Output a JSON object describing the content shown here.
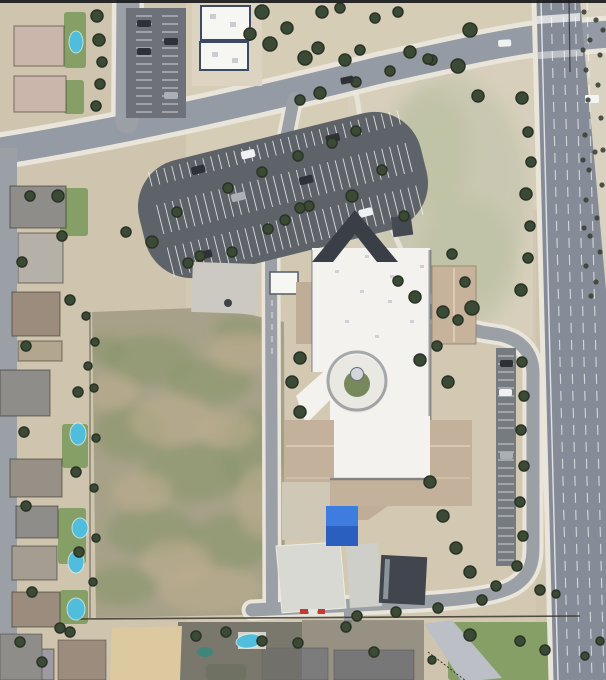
{
  "meta": {
    "view": "satellite-aerial-imagery",
    "width": 606,
    "height": 680
  },
  "visible_text": [],
  "palette": {
    "dirt": "#cfc5ae",
    "dirtLight": "#dcd4c0",
    "campusDirt": "#d3c9b3",
    "neLotDirt": "#d7cfbb",
    "nePatch": "#c8c7b0",
    "nePatchGreen": "#b9bfa1",
    "scrubDirt": "#d9d2c0",
    "fieldBase": "#a6a188",
    "fieldGreen": "#86966a",
    "fieldBrown": "#bcae8e",
    "lawn": "#7c9a5e",
    "road": "#959ba4",
    "roadMinor": "#9aa0a6",
    "roadMajor": "#858c97",
    "asphaltLot": "#5e636a",
    "asphaltAisle": "#767b82",
    "northLot": "#6d727a",
    "sidewalk": "#e9e5da",
    "white": "#f6f6f3",
    "whiteRoof": "#f3f2ee",
    "roofSpeck": "#c6cacf",
    "navyShadow": "#3d4a66",
    "shadow": "#4e555e",
    "roofTanEast": "#c7b29b",
    "roofTanBand": "#c4b19b",
    "roofTanSmall": "#c0ad97",
    "roofDark": "#3a3f47",
    "darkBuilding": "#41464e",
    "concrete": "#d9d9d3",
    "concreteTan": "#cfc8b6",
    "padGray": "#cbc9c2",
    "blueCanopy": "#3f7ce0",
    "blueCanopyDark": "#2a5fc0",
    "pool": "#4fbddb",
    "poolDark": "#3f8579",
    "tree": "#3b4a34",
    "treeDark": "#2a3326",
    "scrub": "#3c4136",
    "stripeWhite": "#f2f2ee",
    "red": "#c33b2f",
    "fence": "#3b382f",
    "domeGray": "#d3d6da",
    "rotundaGreen": "#76885c",
    "carDark": "#2e3238",
    "carWhite": "#f0f1f2",
    "carSilver": "#aab0b6",
    "houseRoofs": {
      "pink": "#cbb6ac",
      "gray": "#8f8d8a",
      "gray2": "#9b9ba1",
      "lightgray": "#b5b0a8",
      "brown": "#9b8c7e",
      "brown2": "#979086",
      "tan": "#b3a68f",
      "tan2": "#a59d92",
      "slate": "#8f9197",
      "pale": "#bcbfc6"
    }
  },
  "scene": {
    "trees": [
      [
        97,
        16,
        6
      ],
      [
        99,
        40,
        6
      ],
      [
        102,
        62,
        5
      ],
      [
        100,
        84,
        5
      ],
      [
        96,
        106,
        5
      ],
      [
        58,
        196,
        6
      ],
      [
        30,
        196,
        5
      ],
      [
        262,
        12,
        7
      ],
      [
        250,
        34,
        6
      ],
      [
        270,
        44,
        7
      ],
      [
        287,
        28,
        6
      ],
      [
        305,
        58,
        7
      ],
      [
        322,
        12,
        6
      ],
      [
        340,
        8,
        5
      ],
      [
        318,
        48,
        6
      ],
      [
        345,
        60,
        6
      ],
      [
        360,
        50,
        5
      ],
      [
        375,
        18,
        5
      ],
      [
        398,
        12,
        5
      ],
      [
        410,
        52,
        6
      ],
      [
        432,
        60,
        5
      ],
      [
        470,
        30,
        7
      ],
      [
        458,
        66,
        7
      ],
      [
        478,
        96,
        6
      ],
      [
        522,
        98,
        6
      ],
      [
        528,
        132,
        5
      ],
      [
        531,
        162,
        5
      ],
      [
        526,
        194,
        6
      ],
      [
        530,
        226,
        5
      ],
      [
        528,
        258,
        5
      ],
      [
        521,
        290,
        6
      ],
      [
        472,
        308,
        7
      ],
      [
        443,
        312,
        6
      ],
      [
        415,
        297,
        6
      ],
      [
        398,
        281,
        5
      ],
      [
        152,
        242,
        6
      ],
      [
        177,
        212,
        5
      ],
      [
        200,
        256,
        5
      ],
      [
        228,
        188,
        5
      ],
      [
        262,
        172,
        5
      ],
      [
        298,
        156,
        5
      ],
      [
        332,
        143,
        5
      ],
      [
        309,
        206,
        5
      ],
      [
        268,
        229,
        5
      ],
      [
        232,
        252,
        5
      ],
      [
        188,
        263,
        5
      ],
      [
        356,
        131,
        5
      ],
      [
        352,
        196,
        6
      ],
      [
        382,
        170,
        5
      ],
      [
        126,
        232,
        5
      ],
      [
        320,
        93,
        6
      ],
      [
        300,
        100,
        5
      ],
      [
        356,
        82,
        5
      ],
      [
        390,
        71,
        5
      ],
      [
        428,
        59,
        5
      ],
      [
        300,
        358,
        6
      ],
      [
        292,
        382,
        6
      ],
      [
        300,
        412,
        6
      ],
      [
        420,
        360,
        6
      ],
      [
        437,
        346,
        5
      ],
      [
        448,
        382,
        6
      ],
      [
        458,
        320,
        5
      ],
      [
        404,
        216,
        5
      ],
      [
        300,
        208,
        5
      ],
      [
        285,
        220,
        5
      ],
      [
        430,
        482,
        6
      ],
      [
        443,
        516,
        6
      ],
      [
        456,
        548,
        6
      ],
      [
        470,
        572,
        6
      ],
      [
        496,
        586,
        5
      ],
      [
        452,
        254,
        5
      ],
      [
        465,
        282,
        5
      ],
      [
        522,
        362,
        5
      ],
      [
        524,
        396,
        5
      ],
      [
        521,
        430,
        5
      ],
      [
        524,
        466,
        5
      ],
      [
        520,
        502,
        5
      ],
      [
        523,
        536,
        5
      ],
      [
        517,
        566,
        5
      ],
      [
        540,
        590,
        5
      ],
      [
        556,
        594,
        4
      ],
      [
        357,
        616,
        5
      ],
      [
        396,
        612,
        5
      ],
      [
        438,
        608,
        5
      ],
      [
        482,
        600,
        5
      ],
      [
        95,
        342,
        4
      ],
      [
        94,
        388,
        4
      ],
      [
        96,
        438,
        4
      ],
      [
        94,
        488,
        4
      ],
      [
        96,
        538,
        4
      ],
      [
        93,
        582,
        4
      ],
      [
        62,
        236,
        5
      ],
      [
        22,
        262,
        5
      ],
      [
        70,
        300,
        5
      ],
      [
        26,
        346,
        5
      ],
      [
        78,
        392,
        5
      ],
      [
        24,
        432,
        5
      ],
      [
        76,
        472,
        5
      ],
      [
        26,
        506,
        5
      ],
      [
        79,
        552,
        5
      ],
      [
        32,
        592,
        5
      ],
      [
        70,
        632,
        5
      ],
      [
        42,
        662,
        5
      ],
      [
        86,
        316,
        4
      ],
      [
        88,
        366,
        4
      ],
      [
        196,
        636,
        5
      ],
      [
        226,
        632,
        5
      ],
      [
        262,
        641,
        5
      ],
      [
        298,
        643,
        5
      ],
      [
        346,
        627,
        5
      ],
      [
        374,
        652,
        5
      ],
      [
        470,
        635,
        6
      ],
      [
        520,
        641,
        5
      ],
      [
        545,
        650,
        5
      ],
      [
        585,
        656,
        4
      ],
      [
        600,
        641,
        4
      ],
      [
        432,
        660,
        4
      ],
      [
        60,
        628,
        5
      ],
      [
        20,
        642,
        5
      ]
    ],
    "scrub": [
      [
        584,
        12
      ],
      [
        596,
        20
      ],
      [
        590,
        40
      ],
      [
        600,
        55
      ],
      [
        586,
        70
      ],
      [
        598,
        85
      ],
      [
        588,
        100
      ],
      [
        601,
        118
      ],
      [
        585,
        135
      ],
      [
        595,
        152
      ],
      [
        589,
        170
      ],
      [
        602,
        185
      ],
      [
        586,
        200
      ],
      [
        597,
        218
      ],
      [
        590,
        236
      ],
      [
        600,
        252
      ],
      [
        586,
        266
      ],
      [
        596,
        282
      ],
      [
        591,
        296
      ],
      [
        603,
        30
      ],
      [
        603,
        150
      ],
      [
        583,
        50
      ],
      [
        583,
        160
      ],
      [
        584,
        228
      ]
    ],
    "pools": [
      [
        76,
        42,
        7,
        11,
        0
      ],
      [
        78,
        434,
        8,
        11,
        0
      ],
      [
        80,
        528,
        8,
        10,
        0
      ],
      [
        76,
        562,
        8,
        11,
        0
      ],
      [
        76,
        609,
        9,
        11,
        0
      ],
      [
        249,
        641,
        13,
        7,
        -8
      ]
    ],
    "poolsDark": [
      [
        205,
        652,
        8,
        5,
        0
      ]
    ],
    "housesLeft": [
      [
        14,
        26,
        50,
        40,
        "pink"
      ],
      [
        14,
        76,
        52,
        36,
        "pink"
      ],
      [
        10,
        186,
        56,
        42,
        "gray"
      ],
      [
        18,
        233,
        45,
        50,
        "lightgray"
      ],
      [
        12,
        292,
        48,
        44,
        "brown"
      ],
      [
        18,
        341,
        44,
        20,
        "tan"
      ],
      [
        0,
        370,
        50,
        46,
        "gray"
      ],
      [
        10,
        459,
        52,
        38,
        "brown2"
      ],
      [
        16,
        506,
        42,
        32,
        "gray"
      ],
      [
        12,
        546,
        45,
        34,
        "tan2"
      ],
      [
        12,
        592,
        48,
        35,
        "brown"
      ],
      [
        16,
        649,
        38,
        31,
        "gray2"
      ]
    ],
    "housesBottom": [
      [
        262,
        648,
        66,
        32,
        "gray2"
      ],
      [
        334,
        650,
        80,
        30,
        "slate"
      ],
      [
        58,
        640,
        48,
        40,
        "brown"
      ],
      [
        0,
        634,
        42,
        46,
        "gray"
      ]
    ],
    "lawns": [
      [
        64,
        12,
        22,
        56
      ],
      [
        64,
        80,
        20,
        34
      ],
      [
        60,
        188,
        28,
        48
      ],
      [
        62,
        424,
        26,
        44
      ],
      [
        58,
        508,
        28,
        56
      ],
      [
        60,
        590,
        28,
        34
      ],
      [
        448,
        622,
        106,
        58
      ],
      [
        566,
        634,
        38,
        46
      ],
      [
        0,
        652,
        52,
        28
      ],
      [
        206,
        664,
        40,
        16
      ]
    ],
    "fieldGreen": [
      [
        150,
        360,
        45,
        25
      ],
      [
        210,
        382,
        42,
        22
      ],
      [
        130,
        432,
        36,
        28
      ],
      [
        192,
        472,
        50,
        30
      ],
      [
        152,
        532,
        46,
        25
      ],
      [
        232,
        542,
        40,
        28
      ],
      [
        122,
        586,
        34,
        20
      ],
      [
        252,
        452,
        30,
        42
      ],
      [
        106,
        350,
        20,
        15
      ],
      [
        240,
        330,
        25,
        14
      ]
    ],
    "fieldBrown": [
      [
        172,
        420,
        42,
        26
      ],
      [
        242,
        352,
        34,
        20
      ],
      [
        142,
        492,
        30,
        20
      ],
      [
        210,
        590,
        52,
        24
      ],
      [
        112,
        392,
        26,
        18
      ],
      [
        262,
        502,
        26,
        36
      ],
      [
        176,
        562,
        36,
        22
      ],
      [
        226,
        430,
        30,
        18
      ]
    ],
    "roofMarks": [
      [
        335,
        270
      ],
      [
        360,
        290
      ],
      [
        390,
        275
      ],
      [
        345,
        320
      ],
      [
        375,
        335
      ],
      [
        410,
        320
      ],
      [
        350,
        385
      ],
      [
        340,
        430
      ],
      [
        370,
        445
      ],
      [
        400,
        430
      ],
      [
        415,
        455
      ],
      [
        355,
        460
      ],
      [
        388,
        300
      ],
      [
        365,
        255
      ],
      [
        420,
        265
      ]
    ],
    "carsLot": [
      [
        200,
        146,
        "carDark"
      ],
      [
        252,
        143,
        "carWhite"
      ],
      [
        302,
        182,
        "carDark"
      ],
      [
        232,
        182,
        "carSilver"
      ],
      [
        186,
        230,
        "carDark"
      ],
      [
        352,
        228,
        "carWhite"
      ],
      [
        338,
        148,
        "carDark"
      ]
    ],
    "carsNorth": [
      [
        137,
        20,
        "carDark"
      ],
      [
        137,
        48,
        "carDark"
      ],
      [
        164,
        92,
        "carSilver"
      ],
      [
        164,
        38,
        "carDark"
      ]
    ],
    "carsLoop": [
      [
        500,
        360,
        "carDark"
      ],
      [
        499,
        389,
        "carWhite"
      ],
      [
        500,
        452,
        "carSilver"
      ]
    ],
    "carsRoad": [
      [
        498,
        40,
        "carWhite",
        -3
      ],
      [
        340,
        78,
        "carDark",
        -12
      ]
    ],
    "lotStripes": {
      "x0": 158,
      "x1": 420,
      "step": 8,
      "bands": [
        [
          140,
          15
        ],
        [
          174,
          30
        ],
        [
          218,
          30
        ]
      ]
    },
    "northStripes": {
      "y0": 16,
      "y1": 112,
      "step": 8,
      "cols": [
        [
          136,
          16
        ],
        [
          162,
          16
        ]
      ]
    },
    "loopStripes": {
      "x": 498,
      "len": 16,
      "step": 8,
      "bands": [
        [
          356,
          428
        ],
        [
          444,
          516
        ],
        [
          528,
          560
        ]
      ]
    },
    "laneDashes": {
      "xTop": [
        551,
        563,
        575,
        587
      ],
      "slope": 17
    }
  }
}
